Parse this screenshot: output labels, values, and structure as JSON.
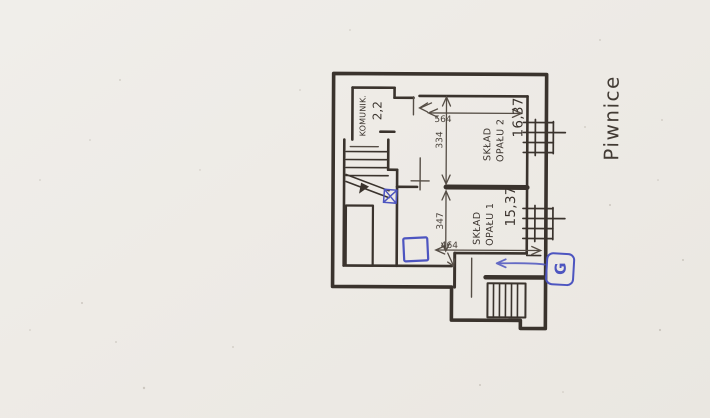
{
  "labels": {
    "floor_title": "Piwnice",
    "room_komunik": {
      "name": "KOMUNIK.",
      "area": "2,2"
    },
    "room_sklad2": {
      "name_line1": "SKŁAD",
      "name_line2": "OPAŁU 2",
      "area": "16,37"
    },
    "room_sklad1": {
      "name_line1": "SKŁAD",
      "name_line2": "OPAŁU 1",
      "area": "15,37"
    }
  },
  "dimensions": {
    "top_width": "564",
    "upper_depth": "334",
    "lower_depth": "347",
    "bottom_width": "464"
  },
  "annotations": {
    "pen_letter": "G"
  },
  "colors": {
    "ink": "#3a332d",
    "pen_blue": "#4d55c0",
    "paper": "#eeebe6"
  }
}
